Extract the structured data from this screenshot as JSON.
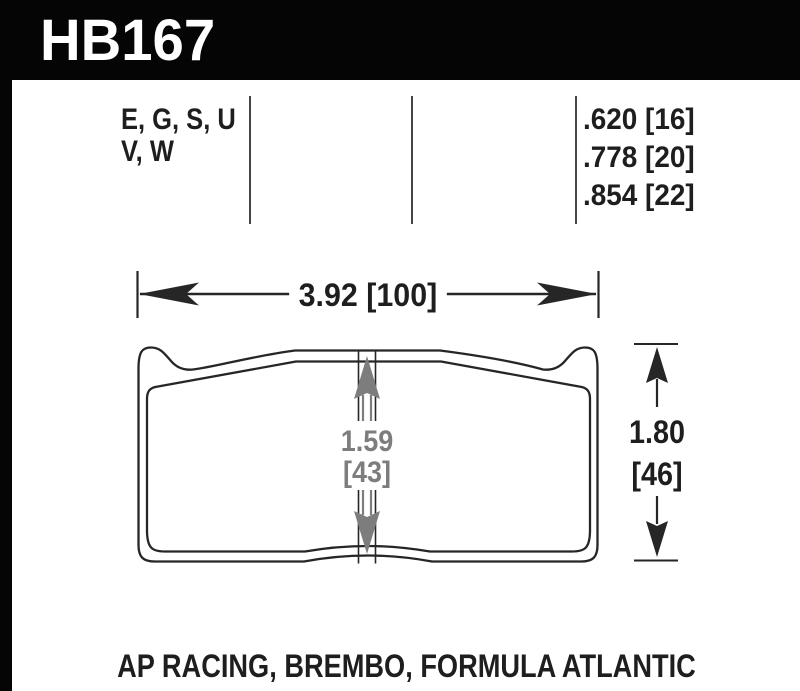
{
  "header": {
    "part_number": "HB167"
  },
  "compounds": {
    "line1": "E, G, S, U",
    "line2": "V, W"
  },
  "thickness_options": [
    ".620 [16]",
    ".778 [20]",
    ".854 [22]"
  ],
  "dimensions": {
    "width_label": "3.92 [100]",
    "height_value": "1.80",
    "height_mm": "[46]",
    "center_value": "1.59",
    "center_mm": "[43]"
  },
  "applications": "AP RACING, BREMBO, FORMULA ATLANTIC",
  "colors": {
    "ink_black": "#1e1e1e",
    "dimension_gray": "#7d7d7d",
    "header_black": "#050505"
  }
}
